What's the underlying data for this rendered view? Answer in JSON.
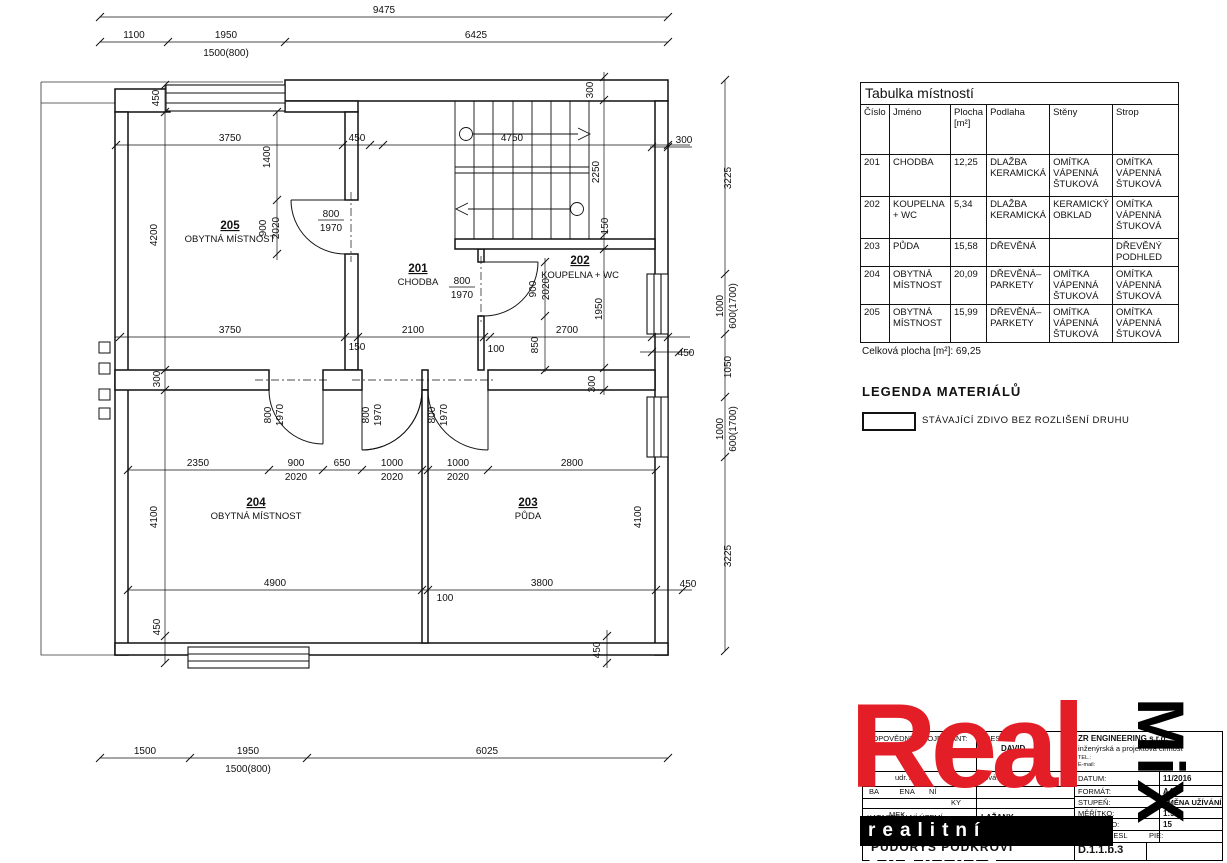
{
  "room_table": {
    "title": "Tabulka místností",
    "columns": [
      "Číslo",
      "Jméno",
      "Plocha\n[m²]",
      "Podlaha",
      "Stěny",
      "Strop"
    ],
    "rows": [
      [
        "201",
        "CHODBA",
        "12,25",
        "DLAŽBA\nKERAMICKÁ",
        "OMÍTKA\nVÁPENNÁ\nŠTUKOVÁ",
        "OMÍTKA\nVÁPENNÁ\nŠTUKOVÁ"
      ],
      [
        "202",
        "KOUPELNA\n+ WC",
        "5,34",
        "DLAŽBA\nKERAMICKÁ",
        "KERAMICKÝ\nOBKLAD",
        "OMÍTKA\nVÁPENNÁ\nŠTUKOVÁ"
      ],
      [
        "203",
        "PŮDA",
        "15,58",
        "DŘEVĚNÁ",
        "",
        "DŘEVĚNÝ\nPODHLED"
      ],
      [
        "204",
        "OBYTNÁ\nMÍSTNOST",
        "20,09",
        "DŘEVĚNÁ–\nPARKETY",
        "OMÍTKA\nVÁPENNÁ\nŠTUKOVÁ",
        "OMÍTKA\nVÁPENNÁ\nŠTUKOVÁ"
      ],
      [
        "205",
        "OBYTNÁ\nMÍSTNOST",
        "15,99",
        "DŘEVĚNÁ–\nPARKETY",
        "OMÍTKA\nVÁPENNÁ\nŠTUKOVÁ",
        "OMÍTKA\nVÁPENNÁ\nŠTUKOVÁ"
      ]
    ],
    "total": "Celková plocha [m²]:  69,25"
  },
  "legend": {
    "title": "LEGENDA MATERIÁLŮ",
    "item": "STÁVAJÍCÍ ZDIVO BEZ ROZLIŠENÍ DRUHU"
  },
  "logo": {
    "wordmark": "Real",
    "vertical": "MiX",
    "tagline": "realitní agentura",
    "red": "#e41e26"
  },
  "titleblock": {
    "resp_label": "ODPOVĚDNÝ PROJEKTANT:",
    "resp_name": "ZDENĚK",
    "drew_label": "KRESLIL:",
    "drew_name": "DAVID",
    "company": "ZR ENGINEERING s.r.o.",
    "company_sub": "inženýrská a projektová činnost",
    "tel": "TEL.:",
    "email": "E-mail:",
    "investor_row": "udr. A                ová          nová 23",
    "row2": "BA          ENA       NÍ",
    "row3": "KY",
    "row4": "MEK",
    "cadastre_label": "KATASTRÁLNÍ ÚZEMÍ:",
    "cadastre_value": "LAŽANY",
    "date_label": "DATUM:",
    "date_value": "11/2016",
    "format_label": "FORMÁT:",
    "format_value": "A4",
    "stage_label": "STUPEŇ:",
    "stage_value": "ZMĚNA UŽÍVÁNÍ",
    "scale_label": "MĚŘÍTKO:",
    "scale_value": "1:50",
    "zak_label": "ZAK.ČÍSLO:",
    "zak_value": "15",
    "copy_label": "KRESL",
    "copy_label2": "PIE:",
    "drawing_title": "PŮDORYS PODKROVÍ",
    "drawing_number": "D.1.1.b.3"
  },
  "plan": {
    "labels": {
      "d9475": "9475",
      "d1100": "1100",
      "d1950t": "1950",
      "d1500t": "1500(800)",
      "d6425": "6425",
      "d450lt": "450",
      "d3750t": "3750",
      "d1400": "1400",
      "d450t": "450",
      "d4750": "4750",
      "d300v": "300",
      "d300r": "300",
      "d2250": "2250",
      "d150s": "150",
      "d4200": "4200",
      "d900a": "900",
      "d2020a": "2020",
      "d800a": "800",
      "d1970a": "1970",
      "r205": "205",
      "r205n": "OBYTNÁ MÍSTNOST",
      "r201": "201",
      "r201n": "CHODBA",
      "r202": "202",
      "r202n": "KOUPELNA + WC",
      "d800b": "800",
      "d1970b": "1970",
      "d900b": "900",
      "d2020b": "2020",
      "d1950v": "1950",
      "d3750m": "3750",
      "d300l": "300",
      "d150m": "150",
      "d2100": "2100",
      "d100m": "100",
      "d850": "850",
      "d2700": "2700",
      "d450rm": "450",
      "d300bv": "300",
      "d3225a": "3225",
      "d1000a": "1000",
      "d600a": "600(1700)",
      "d1050": "1050",
      "d1000b": "1000",
      "d600b": "600(1700)",
      "d3225b": "3225",
      "dd1a": "800",
      "dd1b": "1970",
      "dd2a": "800",
      "dd2b": "1970",
      "dd3a": "800",
      "dd3b": "1970",
      "d2350": "2350",
      "d900c": "900",
      "d2020c": "2020",
      "d650": "650",
      "d1000c": "1000",
      "d2020d": "2020",
      "d1000d": "1000",
      "d2020e": "2020",
      "d2800": "2800",
      "r204": "204",
      "r204n": "OBYTNÁ MÍSTNOST",
      "r203": "203",
      "r203n": "PŮDA",
      "d4100l": "4100",
      "d4100r": "4100",
      "d4900": "4900",
      "d100b": "100",
      "d3800": "3800",
      "d450br": "450",
      "d450bc": "450",
      "d450bl": "450",
      "d1500": "1500",
      "d1950b": "1950",
      "d1500b": "1500(800)",
      "d6025": "6025"
    }
  }
}
